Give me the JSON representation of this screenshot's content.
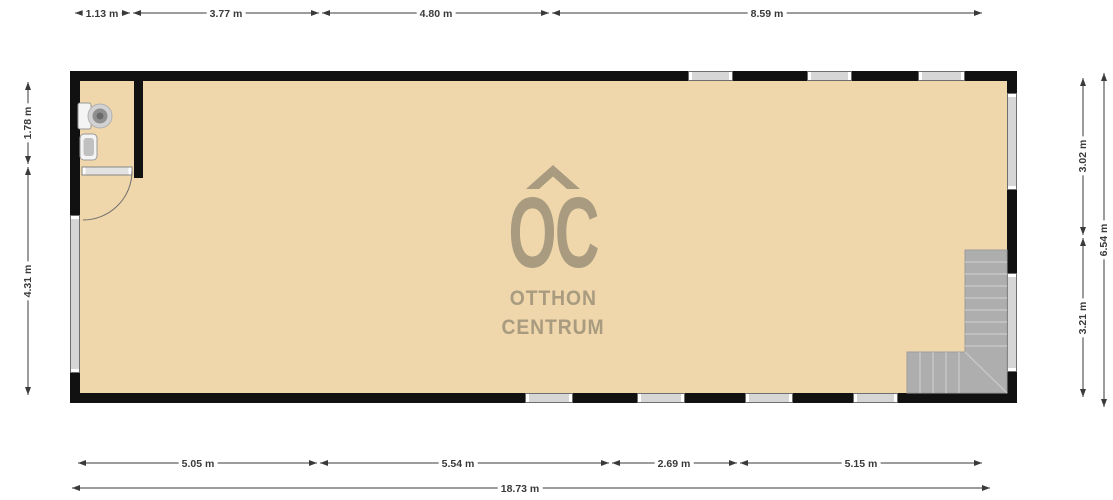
{
  "watermark": {
    "logo": "OC",
    "name_line1": "OTTHON",
    "name_line2": "CENTRUM"
  },
  "dimensions": {
    "top": [
      "1.13 m",
      "3.77 m",
      "4.80 m",
      "8.59 m"
    ],
    "left": [
      "1.78 m",
      "4.31 m"
    ],
    "right_inner": [
      "3.02 m",
      "3.21 m"
    ],
    "right_outer": "6.54 m",
    "bottom": [
      "5.05 m",
      "5.54 m",
      "2.69 m",
      "5.15 m"
    ],
    "bottom_total": "18.73 m"
  },
  "colors": {
    "floor": "#f0d7ab",
    "wall": "#111111",
    "watermark": "#a89b80",
    "stairs": "#aeaeae",
    "stairs-line": "#c6c6c6",
    "window-fill": "#d6d6d6",
    "window-border": "#6e6e6e",
    "dim": "#3a3a3a"
  }
}
